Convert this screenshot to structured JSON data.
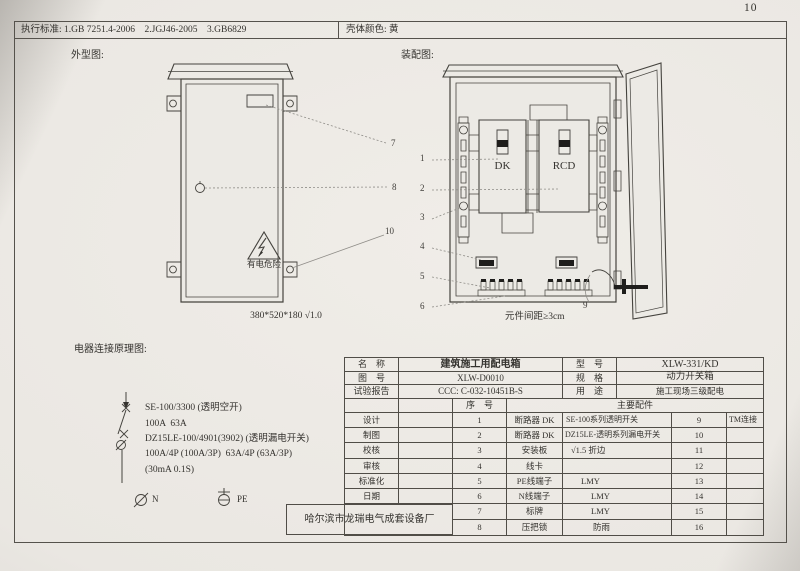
{
  "page": {
    "number": "10"
  },
  "top_bar": {
    "standards": "执行标准: 1.GB 7251.4-2006    2.JGJ46-2005    3.GB6829",
    "shell_color": "壳体颜色: 黄"
  },
  "outline_view": {
    "title": "外型图:",
    "warning_text": "有电危险",
    "dimension_note": "380*520*180 √1.0",
    "callouts": {
      "7": "7",
      "8": "8",
      "10": "10"
    }
  },
  "assembly_view": {
    "title": "装配图:",
    "component_dk": "DK",
    "component_rcd": "RCD",
    "spacing_note": "元件间距≥3cm",
    "callouts": [
      "1",
      "2",
      "3",
      "4",
      "5",
      "6",
      "9"
    ]
  },
  "schematic": {
    "title": "电器连接原理图:",
    "spec_lines": [
      "SE-100/3300 (透明空开)",
      "100A  63A",
      "DZ15LE-100/4901(3902) (透明漏电开关)",
      "100A/4P (100A/3P)  63A/4P (63A/3P)",
      "(30mA 0.1S)"
    ],
    "neutral_label": "N",
    "pe_label": "PE"
  },
  "title_block": {
    "name_label": "名　称",
    "name_value": "建筑施工用配电箱",
    "model_label": "型　号",
    "model_value": "XLW-331/KD",
    "drawing_no_label": "图　号",
    "drawing_no_value": "XLW-D0010",
    "spec_label": "规　格",
    "spec_value": "动力开关箱",
    "test_report_label": "试验报告",
    "test_report_value": "CCC: C-032-10451B-S",
    "use_label": "用　途",
    "use_value": "施工现场三级配电",
    "seq_label": "序　号",
    "main_parts_label": "主要配件",
    "sign_labels": [
      "设计",
      "制图",
      "校核",
      "审核",
      "标准化",
      "日期"
    ],
    "parts_rows": [
      {
        "seq": "1",
        "name": "断路器 DK",
        "desc": "SE-100系列透明开关",
        "seq2": "9",
        "note": "TM连接"
      },
      {
        "seq": "2",
        "name": "断路器 DK",
        "desc": "DZ15LE-透明系列漏电开关",
        "seq2": "10",
        "note": ""
      },
      {
        "seq": "3",
        "name": "安装板",
        "desc": "√1.5 折边",
        "seq2": "11",
        "note": ""
      },
      {
        "seq": "4",
        "name": "线卡",
        "desc": "",
        "seq2": "12",
        "note": ""
      },
      {
        "seq": "5",
        "name": "PE线端子",
        "desc": "LMY",
        "seq2": "13",
        "note": ""
      },
      {
        "seq": "6",
        "name": "N线端子",
        "desc": "LMY",
        "seq2": "14",
        "note": ""
      },
      {
        "seq": "7",
        "name": "标牌",
        "desc": "LMY",
        "seq2": "15",
        "note": ""
      },
      {
        "seq": "8",
        "name": "压把锁",
        "desc": "防雨",
        "seq2": "16",
        "note": ""
      }
    ],
    "manufacturer": "哈尔滨市龙瑞电气成套设备厂"
  }
}
